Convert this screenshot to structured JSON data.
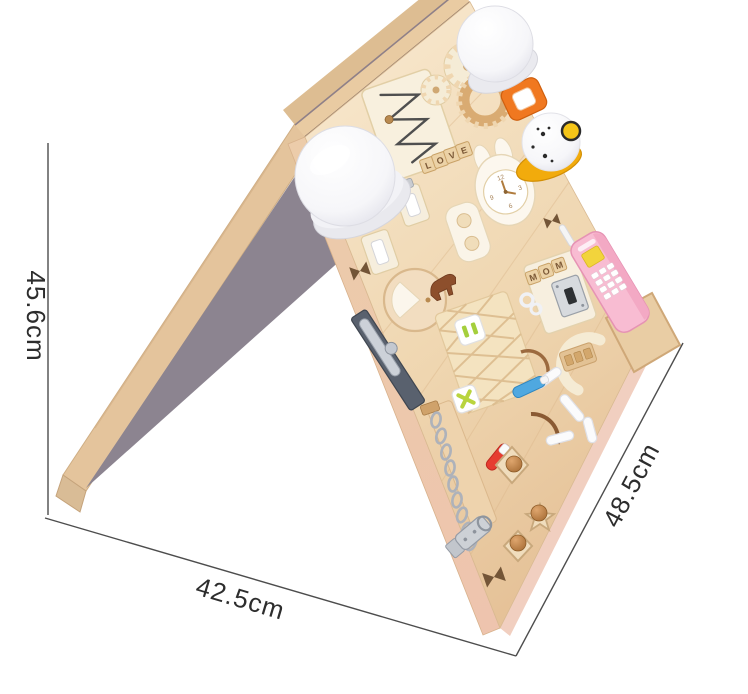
{
  "photo": {
    "subject": "wooden busy board A-frame easel",
    "description": "Montessori wooden busy activity board standing as an A-frame easel on a white studio background, annotated with product dimension lines",
    "background_color": "#ffffff"
  },
  "annotations": {
    "line_color": "#4d4d4d",
    "text_color": "#2d2d2d",
    "height": {
      "label": "45.6cm"
    },
    "width": {
      "label": "42.5cm"
    },
    "depth": {
      "label": "48.5cm"
    }
  },
  "board": {
    "colors": {
      "wood_face": "#eed3ae",
      "wood_edge": "#e9cba2",
      "wood_edge_dark": "#ddbd92",
      "underside_gray": "#8c8490",
      "bottom_edge_pink": "#f1cfc0",
      "phone_pink": "#f8bcd2",
      "bell_yellow": "#f2ab0c",
      "doorbell_orange": "#f07820"
    },
    "tiles": {
      "love": [
        "L",
        "O",
        "V",
        "E"
      ],
      "mom": [
        "M",
        "O",
        "M"
      ]
    },
    "clock_numbers": [
      "12",
      "3",
      "6",
      "9"
    ],
    "items": [
      "push-night-light-large",
      "push-night-light-small",
      "wooden-gears",
      "zigzag-wire-track",
      "doorbell-button",
      "pet-bell",
      "letter-tiles-love",
      "bunny-clock",
      "button-plaque",
      "light-switches",
      "round-door",
      "horse-figure",
      "letter-tiles-mom",
      "cabinet-lock",
      "toy-mobile-phone",
      "phone-holder",
      "barrel-bolt",
      "woven-strap",
      "activity-tiles",
      "marker-pens",
      "chain",
      "hasp-latch",
      "shape-puzzle-knobs",
      "lacing-figures",
      "butterfly-cutouts"
    ]
  }
}
